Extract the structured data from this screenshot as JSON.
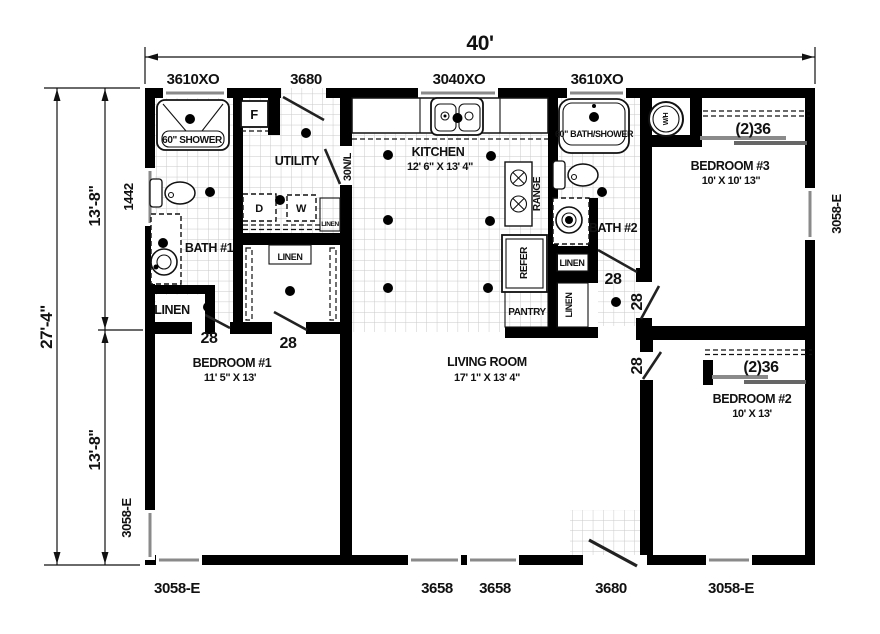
{
  "plan_title": "manufactured-home-floor-plan",
  "dimensions": {
    "overall_width": "40'",
    "overall_depth": "27'-4\"",
    "upper_half": "13'-8\"",
    "lower_half": "13'-8\""
  },
  "schedule": {
    "top": [
      "3610XO",
      "3680",
      "3040XO",
      "3610XO"
    ],
    "bottom": [
      "3058-E",
      "3658",
      "3658",
      "3680",
      "3058-E"
    ],
    "left": [
      "1442",
      "3058-E"
    ],
    "right": [
      "3058-E"
    ]
  },
  "rooms": {
    "utility": {
      "name": "UTILITY"
    },
    "kitchen": {
      "name": "KITCHEN",
      "size": "12' 6\" X 13' 4\""
    },
    "living": {
      "name": "LIVING ROOM",
      "size": "17' 1\" X 13' 4\""
    },
    "bath1": {
      "name": "BATH #1"
    },
    "bath2": {
      "name": "BATH #2"
    },
    "bed1": {
      "name": "BEDROOM #1",
      "size": "11' 5\" X 13'"
    },
    "bed2": {
      "name": "BEDROOM #2",
      "size": "10' X 13'"
    },
    "bed3": {
      "name": "BEDROOM #3",
      "size": "10' X 10' 13\""
    }
  },
  "fixtures": {
    "shower": "60\" SHOWER",
    "tub": "60\" BATH/SHOWER",
    "furnace": "F",
    "dryer": "D",
    "washer": "W",
    "water_heater": "W/H",
    "range": "RANGE",
    "refer": "REFER",
    "pantry": "PANTRY",
    "linen": "LINEN"
  },
  "doors": {
    "d28": "28",
    "d30": "30N/L",
    "c36": "(2)36"
  },
  "colors": {
    "wall": "#000000",
    "tile_grid": "#c9c9c9",
    "slider_bar": "#8a8a8a"
  }
}
